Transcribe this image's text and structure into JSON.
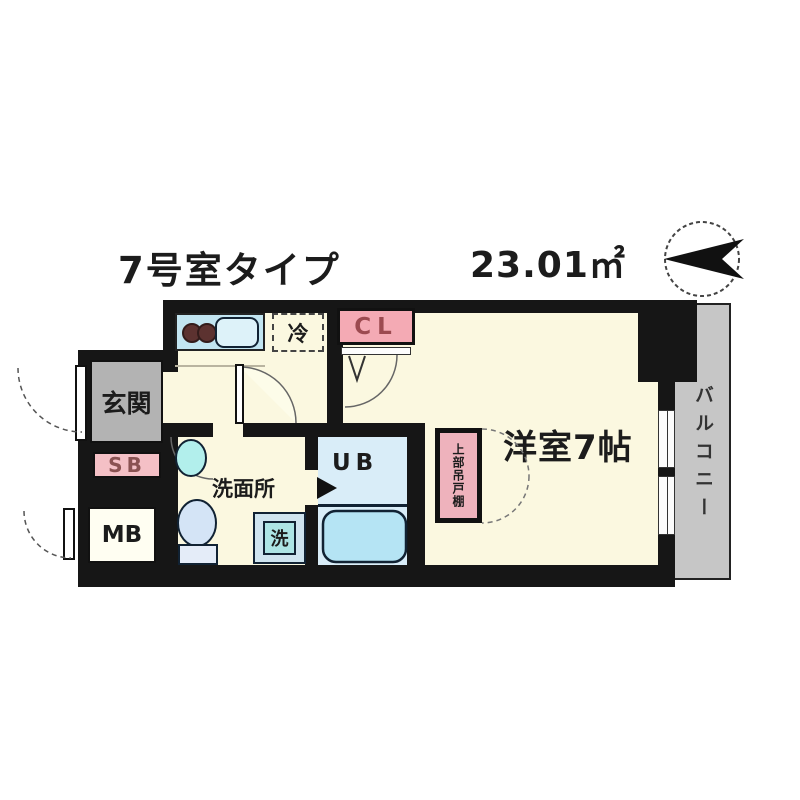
{
  "header": {
    "title": "7号室タイプ",
    "area": "23.01㎡"
  },
  "plan": {
    "entrance": "玄関",
    "shoe_box": "SB",
    "meter_box": "MB",
    "washroom": "洗面所",
    "washer": "洗",
    "unit_bath": "UB",
    "closet": "CL",
    "refrigerator": "冷",
    "main_room": "洋室7帖",
    "balcony": "バルコニー",
    "upper_cabinet": "上部吊戸棚"
  },
  "icons": {
    "compass": "north-arrow"
  },
  "colors": {
    "wall": "#161616",
    "floor_cream": "#fbf8e0",
    "entrance_gray": "#b3b3b3",
    "balcony_gray": "#c6c6c6",
    "pink_box": "#f4aab4",
    "cabinet_pink": "#eeb2bc",
    "kitchen_blue": "#c2e5f1",
    "ub_floor_blue": "#d9edf8",
    "tub_blue": "#b5e4f4",
    "maroon_text": "#9c4a50"
  }
}
